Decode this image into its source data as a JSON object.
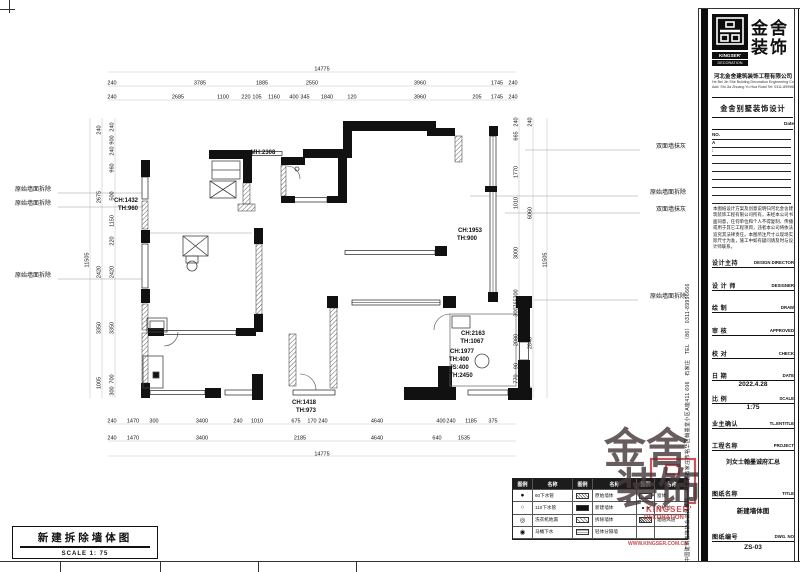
{
  "sheet_title": {
    "title": "新建拆除墙体图",
    "scale": "SCALE 1: 75"
  },
  "brand": {
    "name_cn_1": "金舍",
    "name_cn_2": "装饰",
    "name_en_1": "KINGSER'",
    "name_en_2": "DECORATION"
  },
  "titleblock": {
    "company_cn": "河北金舍建筑装饰工程有限公司",
    "company_en_l1": "He Bei Jin She Building Decoration Engineering Co., Ltd.",
    "company_en_l2": "Add: Shi Jia Zhuang Yu Hua Road  Tel: 0311-89996666",
    "dept_title": "金舍别墅装饰设计",
    "date_label": "Date",
    "no_label": "NO.",
    "a_label": "A",
    "colon_label": ":",
    "notice": "本图纸设计方案及创意说明归河北金舍建筑装饰工程有限公司所有，未经本公司书面同意，任何单位和个人不得复制、传播或用于其它工程项目，违者本公司将依法追究其法律责任。本图所注尺寸以现场实际尺寸为准，施工中如有疑问请及时与设计师联系。",
    "vertical_text": "中国建筑装饰协会会员单位　河北省石家庄市裕华区翰墨堂小区A座411 606　石家庄　TEL （86） 0311-89996666",
    "fields": [
      {
        "label": "设计主持",
        "en": "DESIGN DIRECTOR",
        "value": ""
      },
      {
        "label": "设 计 师",
        "en": "DESIGNER",
        "value": ""
      },
      {
        "label": "绘 制",
        "en": "DRAW",
        "value": ""
      },
      {
        "label": "审 核",
        "en": "APPROVED",
        "value": ""
      },
      {
        "label": "校 对",
        "en": "CHECK",
        "value": ""
      },
      {
        "label": "日 期",
        "en": "DATE",
        "value": "2022.4.28"
      },
      {
        "label": "比 例",
        "en": "SCALE",
        "value": "1:75"
      },
      {
        "label": "业主确认",
        "en": "TL.ENTITLE",
        "value": ""
      },
      {
        "label": "工程名称",
        "en": "PROJECT",
        "value": "刘女士翰墨诚府汇总"
      },
      {
        "label": "图纸名称",
        "en": "TITLE",
        "value": "新建墙体图"
      },
      {
        "label": "图纸编号",
        "en": "DWG. NO",
        "value": "ZS-03"
      }
    ]
  },
  "legend": {
    "headers": [
      "图例",
      "名称",
      "图例",
      "名称",
      "图例",
      "名称"
    ],
    "rows": [
      {
        "s0": "●",
        "n0": "60下水管",
        "s1": "hatch",
        "n1": "原始墙体",
        "s2": "win",
        "n2": "窗体"
      },
      {
        "s0": "○",
        "n0": "110下水管",
        "s1": "solid",
        "n1": "新建墙体",
        "s2": "plug",
        "n2": "外机位"
      },
      {
        "s0": "◎",
        "n0": "洗衣机地漏",
        "s1": "cross",
        "n1": "拆除墙体",
        "s2": "flue",
        "n2": "烟道风道"
      },
      {
        "s0": "◉",
        "n0": "马桶下水",
        "s1": "lines",
        "n1": "轻体分隔墙",
        "s2": "",
        "n2": ""
      }
    ]
  },
  "watermark": {
    "cn1": "金舍",
    "cn2": "装饰",
    "en1": "KINGSER'",
    "en2": "DECORATION",
    "url": "WWW.KINGSER.COM.CN"
  },
  "plan": {
    "texts": [
      {
        "t": "14775",
        "x": 322,
        "y": 70
      },
      {
        "t": "240",
        "x": 112,
        "y": 84
      },
      {
        "t": "3785",
        "x": 200,
        "y": 84
      },
      {
        "t": "1885",
        "x": 262,
        "y": 84
      },
      {
        "t": "2550",
        "x": 312,
        "y": 84
      },
      {
        "t": "3960",
        "x": 420,
        "y": 84
      },
      {
        "t": "1745",
        "x": 497,
        "y": 84
      },
      {
        "t": "240",
        "x": 513,
        "y": 84
      },
      {
        "t": "240",
        "x": 112,
        "y": 98
      },
      {
        "t": "2685",
        "x": 178,
        "y": 98
      },
      {
        "t": "1100",
        "x": 223,
        "y": 98
      },
      {
        "t": "220",
        "x": 246,
        "y": 98
      },
      {
        "t": "105",
        "x": 257,
        "y": 98
      },
      {
        "t": "1160",
        "x": 274,
        "y": 98
      },
      {
        "t": "400",
        "x": 294,
        "y": 98
      },
      {
        "t": "345",
        "x": 305,
        "y": 98
      },
      {
        "t": "1840",
        "x": 327,
        "y": 98
      },
      {
        "t": "120",
        "x": 352,
        "y": 98
      },
      {
        "t": "3960",
        "x": 420,
        "y": 98
      },
      {
        "t": "205",
        "x": 477,
        "y": 98
      },
      {
        "t": "1745",
        "x": 497,
        "y": 98
      },
      {
        "t": "240",
        "x": 513,
        "y": 98
      },
      {
        "t": "240",
        "x": 112,
        "y": 422
      },
      {
        "t": "1470",
        "x": 133,
        "y": 422
      },
      {
        "t": "300",
        "x": 154,
        "y": 422
      },
      {
        "t": "3400",
        "x": 202,
        "y": 422
      },
      {
        "t": "240",
        "x": 238,
        "y": 422
      },
      {
        "t": "1010",
        "x": 257,
        "y": 422
      },
      {
        "t": "675",
        "x": 296,
        "y": 422
      },
      {
        "t": "170",
        "x": 312,
        "y": 422
      },
      {
        "t": "240",
        "x": 323,
        "y": 422
      },
      {
        "t": "4640",
        "x": 377,
        "y": 422
      },
      {
        "t": "400",
        "x": 441,
        "y": 422
      },
      {
        "t": "240",
        "x": 451,
        "y": 422
      },
      {
        "t": "1185",
        "x": 471,
        "y": 422
      },
      {
        "t": "375",
        "x": 493,
        "y": 422
      },
      {
        "t": "240",
        "x": 112,
        "y": 439
      },
      {
        "t": "1470",
        "x": 133,
        "y": 439
      },
      {
        "t": "3400",
        "x": 202,
        "y": 439
      },
      {
        "t": "2185",
        "x": 300,
        "y": 439
      },
      {
        "t": "4640",
        "x": 377,
        "y": 439
      },
      {
        "t": "640",
        "x": 437,
        "y": 439
      },
      {
        "t": "1535",
        "x": 464,
        "y": 439
      },
      {
        "t": "14775",
        "x": 322,
        "y": 455
      },
      {
        "t": "11505",
        "x": 88,
        "y": 260,
        "r": -90
      },
      {
        "t": "240",
        "x": 100,
        "y": 130,
        "r": -90
      },
      {
        "t": "2675",
        "x": 100,
        "y": 197,
        "r": -90
      },
      {
        "t": "2420",
        "x": 100,
        "y": 272,
        "r": -90
      },
      {
        "t": "3350",
        "x": 100,
        "y": 328,
        "r": -90
      },
      {
        "t": "1005",
        "x": 100,
        "y": 383,
        "r": -90
      },
      {
        "t": "240",
        "x": 113,
        "y": 127,
        "r": -90
      },
      {
        "t": "900",
        "x": 113,
        "y": 140,
        "r": -90
      },
      {
        "t": "240",
        "x": 113,
        "y": 151,
        "r": -90
      },
      {
        "t": "960",
        "x": 113,
        "y": 168,
        "r": -90
      },
      {
        "t": "500",
        "x": 113,
        "y": 196,
        "r": -90
      },
      {
        "t": "1150",
        "x": 113,
        "y": 221,
        "r": -90
      },
      {
        "t": "220",
        "x": 113,
        "y": 241,
        "r": -90
      },
      {
        "t": "2420",
        "x": 113,
        "y": 272,
        "r": -90
      },
      {
        "t": "3350",
        "x": 113,
        "y": 328,
        "r": -90
      },
      {
        "t": "700",
        "x": 113,
        "y": 379,
        "r": -90
      },
      {
        "t": "300",
        "x": 113,
        "y": 391,
        "r": -90
      },
      {
        "t": "240",
        "x": 517,
        "y": 122,
        "r": -90
      },
      {
        "t": "665",
        "x": 517,
        "y": 136,
        "r": -90
      },
      {
        "t": "1770",
        "x": 517,
        "y": 172,
        "r": -90
      },
      {
        "t": "1010",
        "x": 517,
        "y": 203,
        "r": -90
      },
      {
        "t": "3000",
        "x": 517,
        "y": 253,
        "r": -90
      },
      {
        "t": "300",
        "x": 517,
        "y": 294,
        "r": -90
      },
      {
        "t": "765",
        "x": 517,
        "y": 303,
        "r": -90
      },
      {
        "t": "300",
        "x": 517,
        "y": 312,
        "r": -90
      },
      {
        "t": "2080",
        "x": 517,
        "y": 340,
        "r": -90
      },
      {
        "t": "90",
        "x": 517,
        "y": 366,
        "r": -90
      },
      {
        "t": "770",
        "x": 517,
        "y": 379,
        "r": -90
      },
      {
        "t": "240",
        "x": 531,
        "y": 122,
        "r": -90
      },
      {
        "t": "6060",
        "x": 531,
        "y": 213,
        "r": -90
      },
      {
        "t": "765",
        "x": 531,
        "y": 303,
        "r": -90
      },
      {
        "t": "2840",
        "x": 531,
        "y": 343,
        "r": -90
      },
      {
        "t": "300",
        "x": 531,
        "y": 391,
        "r": -90
      },
      {
        "t": "11505",
        "x": 546,
        "y": 260,
        "r": -90
      },
      {
        "t": "MH:2308",
        "x": 263,
        "y": 153,
        "s": 6,
        "b": 1,
        "n": "ceiling-height-annotation"
      },
      {
        "t": "CH:1432",
        "x": 126,
        "y": 201,
        "s": 6,
        "b": 1,
        "n": "window-annotation"
      },
      {
        "t": "TH:960",
        "x": 128,
        "y": 209,
        "s": 6,
        "b": 1,
        "n": "window-annotation"
      },
      {
        "t": "CH:1953",
        "x": 470,
        "y": 231,
        "s": 6,
        "b": 1,
        "n": "window-annotation"
      },
      {
        "t": "TH:900",
        "x": 467,
        "y": 239,
        "s": 6,
        "b": 1,
        "n": "window-annotation"
      },
      {
        "t": "CH:2163",
        "x": 473,
        "y": 334,
        "s": 6,
        "b": 1,
        "n": "window-annotation"
      },
      {
        "t": "TH:1067",
        "x": 472,
        "y": 342,
        "s": 6,
        "b": 1,
        "n": "window-annotation"
      },
      {
        "t": "CH:1977",
        "x": 462,
        "y": 352,
        "s": 6,
        "b": 1,
        "n": "window-annotation"
      },
      {
        "t": "TH:400",
        "x": 459,
        "y": 360,
        "s": 6,
        "b": 1,
        "n": "window-annotation"
      },
      {
        "t": "JS:400",
        "x": 459,
        "y": 368,
        "s": 6,
        "b": 1,
        "n": "window-annotation"
      },
      {
        "t": "TH:2450",
        "x": 461,
        "y": 376,
        "s": 6,
        "b": 1,
        "n": "window-annotation"
      },
      {
        "t": "CH:1418",
        "x": 304,
        "y": 403,
        "s": 6,
        "b": 1,
        "n": "window-annotation"
      },
      {
        "t": "TH:973",
        "x": 306,
        "y": 411,
        "s": 6,
        "b": 1,
        "n": "window-annotation"
      },
      {
        "t": "原始墙面拆除",
        "x": 33,
        "y": 190,
        "s": 6,
        "n": "wall-demolish-label"
      },
      {
        "t": "原始墙面拆除",
        "x": 33,
        "y": 204,
        "s": 6,
        "n": "wall-demolish-label"
      },
      {
        "t": "原始墙面拆除",
        "x": 33,
        "y": 276,
        "s": 6,
        "n": "wall-demolish-label"
      },
      {
        "t": "双面墙抹灰",
        "x": 671,
        "y": 147,
        "s": 6,
        "n": "wall-plaster-label"
      },
      {
        "t": "原始墙面拆除",
        "x": 668,
        "y": 193,
        "s": 6,
        "n": "wall-demolish-label"
      },
      {
        "t": "双面墙抹灰",
        "x": 671,
        "y": 210,
        "s": 6,
        "n": "wall-plaster-label"
      },
      {
        "t": "原始墙面拆除",
        "x": 668,
        "y": 297,
        "s": 6,
        "n": "wall-demolish-label"
      }
    ]
  }
}
